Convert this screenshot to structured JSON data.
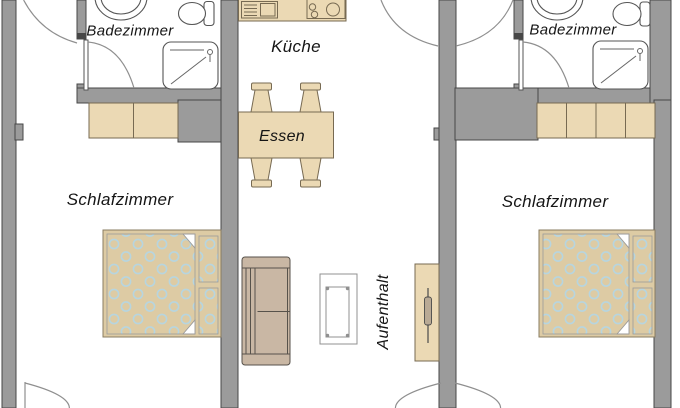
{
  "plan": {
    "type": "floor-plan",
    "rooms": {
      "bath_left": {
        "label": "Badezimmer"
      },
      "kitchen": {
        "label": "Küche"
      },
      "bath_right": {
        "label": "Badezimmer"
      },
      "bedroom_left": {
        "label": "Schlafzimmer"
      },
      "dining": {
        "label": "Essen"
      },
      "bedroom_right": {
        "label": "Schlafzimmer"
      },
      "lounge": {
        "label": "Aufenthalt"
      }
    },
    "colors": {
      "wall": "#9b9b9b",
      "wall_outline": "#474747",
      "room": "#ffffff",
      "furniture": "#ebd9b4",
      "furniture_outline": "#776a52",
      "bed_frame": "#ddcba4",
      "duvet_dot": "#b7d5df",
      "sofa": "#c9b7a4",
      "sofa_outline": "#57524b"
    }
  }
}
